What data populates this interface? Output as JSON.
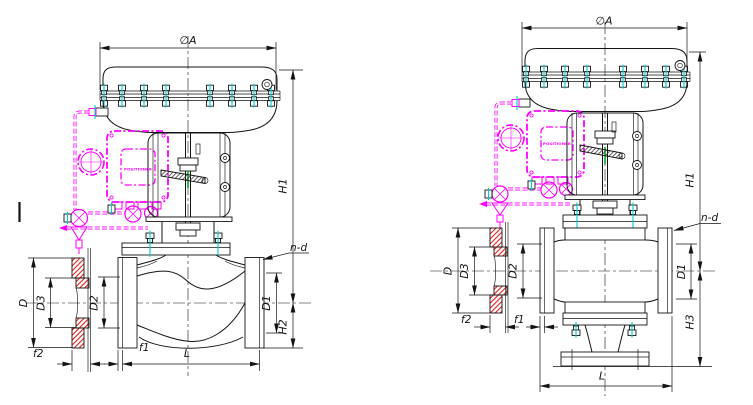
{
  "drawing": {
    "description": "Pneumatic diaphragm control valves with positioner - dimensional outline drawing",
    "colors": {
      "line": "#141414",
      "positioner_magenta": "#ff00ff",
      "bolt_mark_cyan": "#00cbcb",
      "flange_hatch_red": "#e02020",
      "stem_mark_green": "#00aa22",
      "background": "#ffffff"
    },
    "left_view": {
      "name": "two-way globe control valve with diaphragm actuator",
      "positioner_label": "POSITIONER",
      "dims": {
        "dia_a": "∅A",
        "h1": "H1",
        "h2": "H2",
        "n_d": "n-d",
        "d": "D",
        "d1": "D1",
        "d2": "D2",
        "d3": "D3",
        "f1": "f1",
        "f2": "f2",
        "l": "L"
      }
    },
    "right_view": {
      "name": "three-way control valve with diaphragm actuator",
      "positioner_label": "POSITIONER",
      "dims": {
        "dia_a": "∅A",
        "h1": "H1",
        "h3": "H3",
        "n_d": "n-d",
        "d": "D",
        "d1": "D1",
        "d2": "D2",
        "d3": "D3",
        "f1": "f1",
        "f2": "f2",
        "l": "L"
      }
    }
  }
}
